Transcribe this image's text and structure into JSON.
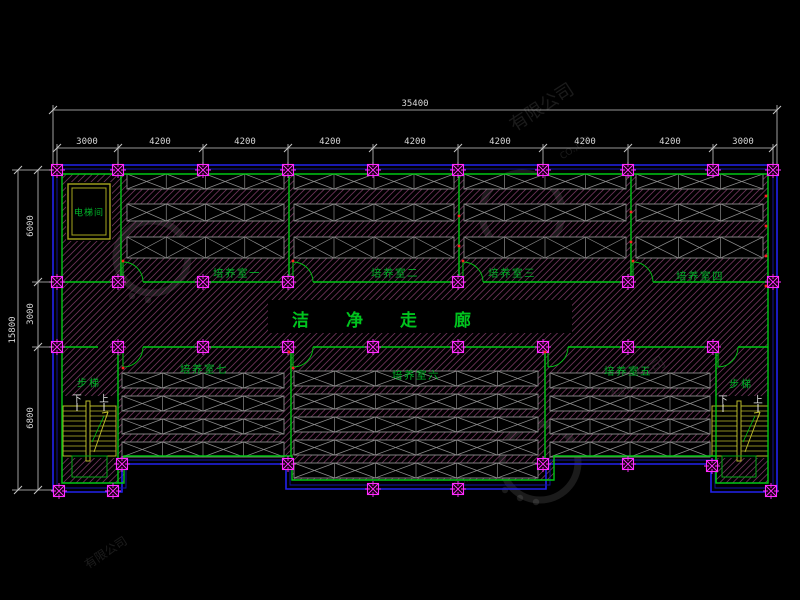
{
  "drawing": {
    "corridor_label": "洁净走廊",
    "elevator_label": "电梯间",
    "stair_label": "步梯",
    "down_label": "下",
    "up_label": "上",
    "room_labels": [
      "培养室一",
      "培养室二",
      "培养室三",
      "培养室四",
      "培养室五",
      "培养室六",
      "培养室七"
    ]
  },
  "dimensions": {
    "top": {
      "total": "35400",
      "segments": [
        "3000",
        "4200",
        "4200",
        "4200",
        "4200",
        "4200",
        "4200",
        "4200",
        "3000"
      ]
    },
    "left": {
      "total": "15800",
      "segments": [
        "6000",
        "3000",
        "6800"
      ]
    }
  },
  "watermark": {
    "text": "有限公司",
    "subtext": "CO.,LTD"
  },
  "colors": {
    "background": "#000000",
    "wall_blue": "#2222ee",
    "wall_blue_dark": "#1515a8",
    "wall_green": "#00c814",
    "column_magenta": "#ff2cff",
    "hatch_pink": "#8a4070",
    "rack_gray": "#8c8c8c",
    "stair_yellow": "#b9b92a",
    "elevator_olive": "#a6a61e",
    "dim_gray": "#c8c8c8",
    "label_green": "#00b428",
    "red_mark": "#ff2020",
    "watermark_gray": "rgba(220,220,220,0.12)"
  },
  "plan": {
    "grid_x": [
      57,
      118,
      203,
      288,
      373,
      458,
      543,
      628,
      713,
      773
    ],
    "outline_outer": "M53,165 H777 V492 H711 V464 H546 V489 H286 V464 H122 V492 H53 Z",
    "outline_mid": "M57,169 H773 V488 H715 V460 H550 V485 H290 V460 H126 V488 H57 Z",
    "outline_inner": "M62,174 H768 V483 H716 V456 H554 V480 H292 V456 H124 V483 H62 Z",
    "corridor_walls": [
      {
        "y": 282,
        "segments": [
          [
            62,
            123
          ],
          [
            143,
            293
          ],
          [
            313,
            463
          ],
          [
            483,
            633
          ],
          [
            653,
            768
          ]
        ]
      },
      {
        "y": 347,
        "segments": [
          [
            62,
            98
          ],
          [
            116,
            123
          ],
          [
            143,
            293
          ],
          [
            313,
            548
          ],
          [
            568,
            718
          ],
          [
            738,
            768
          ]
        ]
      }
    ],
    "partitions": [
      [
        121,
        174,
        282
      ],
      [
        289,
        174,
        282
      ],
      [
        459,
        174,
        282
      ],
      [
        631,
        174,
        282
      ],
      [
        118,
        347,
        483
      ],
      [
        291,
        347,
        456
      ],
      [
        545,
        347,
        461
      ],
      [
        716,
        347,
        483
      ]
    ],
    "doors": [
      [
        123,
        282,
        -1
      ],
      [
        293,
        282,
        -1
      ],
      [
        463,
        282,
        -1
      ],
      [
        633,
        282,
        -1
      ],
      [
        123,
        347,
        1
      ],
      [
        293,
        347,
        1
      ],
      [
        548,
        347,
        1
      ],
      [
        718,
        347,
        1
      ]
    ],
    "columns": [
      [
        57,
        170
      ],
      [
        118,
        170
      ],
      [
        203,
        170
      ],
      [
        288,
        170
      ],
      [
        373,
        170
      ],
      [
        458,
        170
      ],
      [
        543,
        170
      ],
      [
        628,
        170
      ],
      [
        713,
        170
      ],
      [
        773,
        170
      ],
      [
        57,
        282
      ],
      [
        118,
        282
      ],
      [
        203,
        282
      ],
      [
        288,
        282
      ],
      [
        458,
        282
      ],
      [
        628,
        282
      ],
      [
        773,
        282
      ],
      [
        57,
        347
      ],
      [
        118,
        347
      ],
      [
        203,
        347
      ],
      [
        288,
        347
      ],
      [
        373,
        347
      ],
      [
        458,
        347
      ],
      [
        543,
        347
      ],
      [
        628,
        347
      ],
      [
        713,
        347
      ],
      [
        122,
        464
      ],
      [
        288,
        464
      ],
      [
        543,
        464
      ],
      [
        628,
        464
      ],
      [
        712,
        466
      ],
      [
        373,
        489
      ],
      [
        458,
        489
      ],
      [
        59,
        491
      ],
      [
        113,
        491
      ],
      [
        771,
        491
      ]
    ],
    "racks": [
      {
        "x1": 127,
        "x2": 284,
        "bands": [
          [
            174,
            15
          ],
          [
            204,
            17
          ],
          [
            237,
            21
          ]
        ]
      },
      {
        "x1": 294,
        "x2": 454,
        "bands": [
          [
            174,
            15
          ],
          [
            204,
            17
          ],
          [
            237,
            21
          ]
        ]
      },
      {
        "x1": 464,
        "x2": 626,
        "bands": [
          [
            174,
            15
          ],
          [
            204,
            17
          ],
          [
            237,
            21
          ]
        ]
      },
      {
        "x1": 636,
        "x2": 763,
        "bands": [
          [
            174,
            15
          ],
          [
            204,
            17
          ],
          [
            237,
            21
          ]
        ]
      },
      {
        "x1": 122,
        "x2": 284,
        "bands": [
          [
            373,
            15
          ],
          [
            396,
            15
          ],
          [
            419,
            15
          ],
          [
            442,
            15
          ]
        ]
      },
      {
        "x1": 294,
        "x2": 538,
        "bands": [
          [
            371,
            15
          ],
          [
            394,
            15
          ],
          [
            417,
            15
          ],
          [
            440,
            15
          ],
          [
            463,
            15
          ]
        ]
      },
      {
        "x1": 550,
        "x2": 710,
        "bands": [
          [
            373,
            15
          ],
          [
            396,
            15
          ],
          [
            419,
            15
          ],
          [
            442,
            15
          ]
        ]
      }
    ],
    "stairs": [
      {
        "x1": 63,
        "x2": 116,
        "y1": 406,
        "y2": 456,
        "div": 88,
        "label": [
          89,
          382
        ],
        "down": [
          77,
          398
        ],
        "up": [
          104,
          398
        ]
      },
      {
        "x1": 712,
        "x2": 768,
        "y1": 406,
        "y2": 456,
        "div": 739,
        "label": [
          741,
          383
        ],
        "down": [
          723,
          399
        ],
        "up": [
          758,
          399
        ]
      }
    ],
    "stair_boxes": [
      [
        72,
        456,
        35,
        21
      ],
      [
        722,
        456,
        34,
        21
      ]
    ],
    "elevator": {
      "outer": [
        68,
        184,
        42,
        55
      ],
      "inner": [
        72,
        188,
        34,
        47
      ],
      "label": [
        89,
        211
      ]
    },
    "black_areas": [
      [
        268,
        300,
        304,
        33
      ],
      [
        66,
        182,
        46,
        59
      ],
      [
        60,
        396,
        58,
        62
      ],
      [
        710,
        396,
        60,
        62
      ]
    ],
    "room_label_pos": [
      [
        237,
        273
      ],
      [
        395,
        273
      ],
      [
        512,
        273
      ],
      [
        700,
        276
      ],
      [
        628,
        371
      ],
      [
        416,
        375
      ],
      [
        204,
        369
      ]
    ],
    "dims": {
      "top_total": {
        "y": 110,
        "x1": 53,
        "x2": 777,
        "label": [
          415,
          104
        ]
      },
      "top_seg": {
        "y": 148,
        "label_y": 142,
        "label_x": [
          87,
          160,
          245,
          330,
          415,
          500,
          585,
          670,
          743
        ],
        "ext_y1": 144,
        "ext_y2": 164
      },
      "left_total": {
        "x": 18,
        "y1": 170,
        "y2": 490,
        "label": [
          13,
          330
        ]
      },
      "left_seg": {
        "x": 38,
        "ticks": [
          170,
          282,
          347,
          490
        ],
        "label_x": 31,
        "label_y": [
          226,
          314,
          418
        ],
        "ext_x2": 53
      }
    },
    "red_dots": [
      [
        123,
        261
      ],
      [
        293,
        261
      ],
      [
        463,
        261
      ],
      [
        633,
        261
      ],
      [
        766,
        196
      ],
      [
        766,
        226
      ],
      [
        766,
        256
      ],
      [
        766,
        286
      ],
      [
        631,
        212
      ],
      [
        631,
        242
      ],
      [
        459,
        216
      ],
      [
        459,
        246
      ],
      [
        545,
        352
      ],
      [
        289,
        352
      ],
      [
        123,
        368
      ],
      [
        293,
        368
      ]
    ],
    "white_ticks": [
      [
        77,
        403,
        77,
        411
      ],
      [
        104,
        403,
        104,
        411
      ],
      [
        723,
        404,
        723,
        412
      ],
      [
        758,
        404,
        758,
        412
      ]
    ],
    "watermarks": {
      "circles": [
        [
          152,
          257,
          36
        ],
        [
          522,
          213,
          40
        ],
        [
          540,
          462,
          38
        ]
      ],
      "dots": [
        [
          120,
          284
        ],
        [
          132,
          296
        ],
        [
          148,
          300
        ],
        [
          505,
          490
        ],
        [
          520,
          498
        ],
        [
          536,
          502
        ],
        [
          488,
          240
        ],
        [
          500,
          250
        ]
      ],
      "texts": [
        {
          "pos": [
            545,
            112
          ],
          "size": 18,
          "key": "text"
        },
        {
          "pos": [
            640,
            382
          ],
          "size": 16,
          "key": "text"
        },
        {
          "pos": [
            577,
            150
          ],
          "size": 9,
          "key": "subtext"
        },
        {
          "pos": [
            108,
            556
          ],
          "size": 12,
          "key": "text"
        },
        {
          "pos": [
            470,
            480
          ],
          "size": 9,
          "key": "subtext"
        }
      ]
    }
  }
}
